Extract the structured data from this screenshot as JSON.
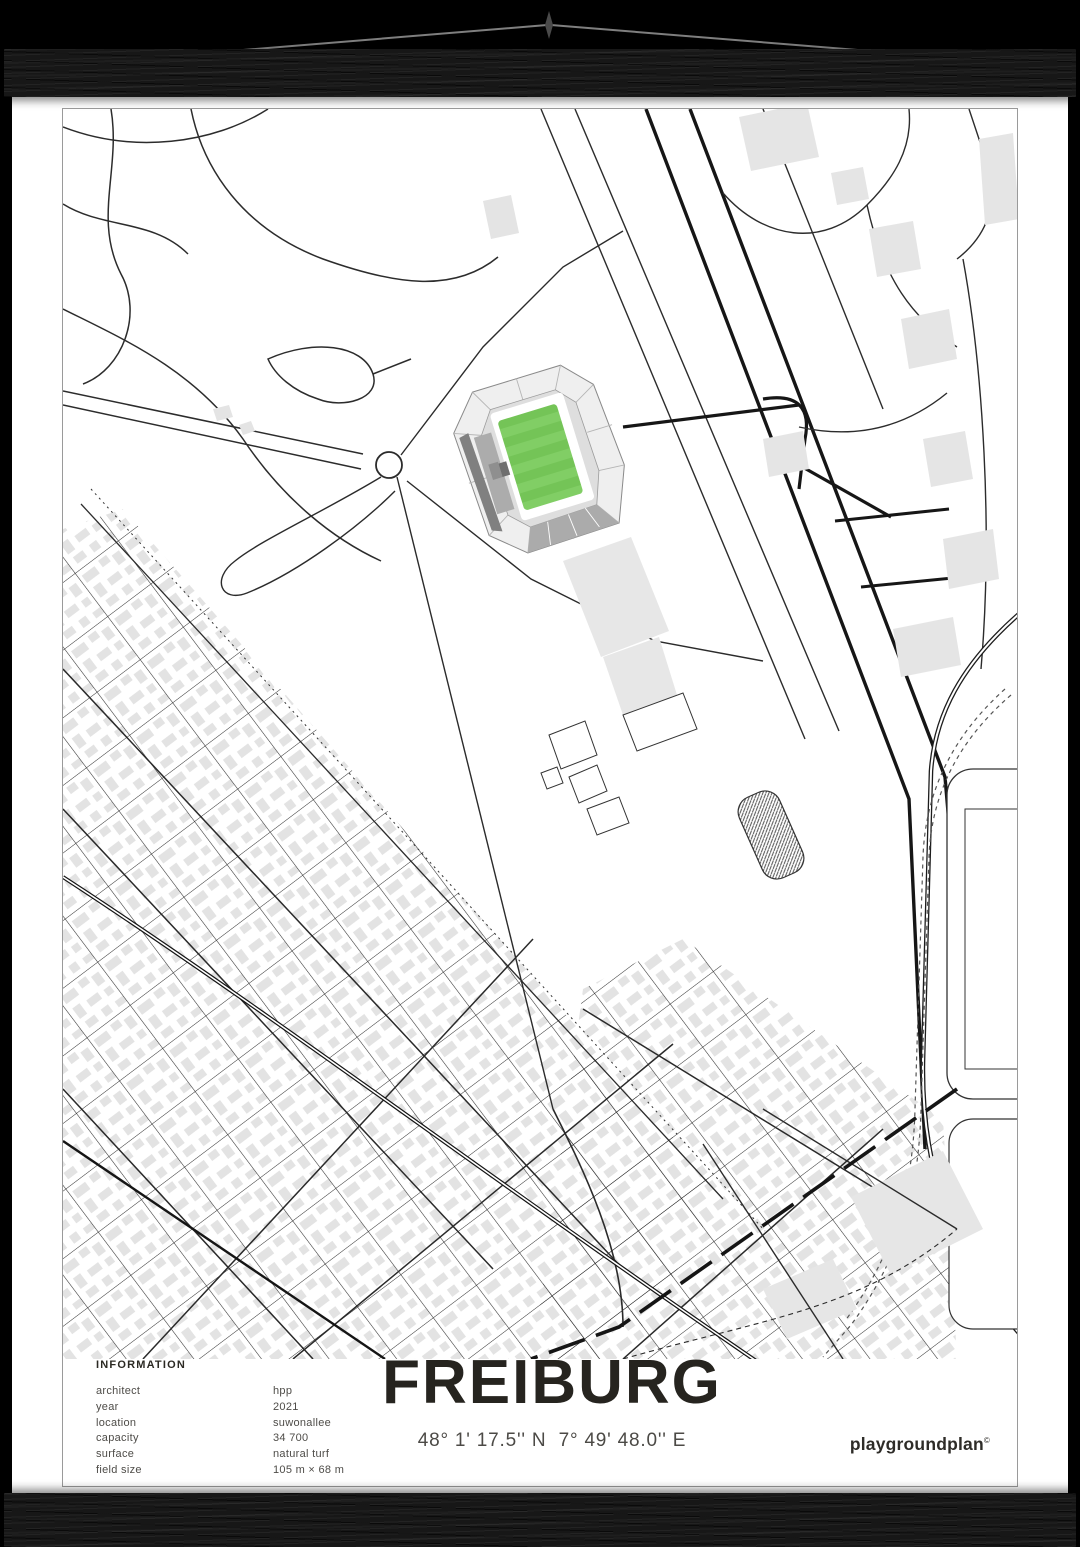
{
  "poster": {
    "title": "FREIBURG",
    "coordinates": "48° 1' 17.5'' N  7° 49' 48.0'' E",
    "brand": {
      "name": "playgroundplan",
      "mark": "©"
    },
    "information": {
      "heading": "INFORMATION",
      "rows": [
        {
          "label": "architect",
          "value": "hpp"
        },
        {
          "label": "year",
          "value": "2021"
        },
        {
          "label": "location",
          "value": "suwonallee"
        },
        {
          "label": "capacity",
          "value": "34 700"
        },
        {
          "label": "surface",
          "value": "natural turf"
        },
        {
          "label": "field size",
          "value": "105 m × 68 m"
        }
      ]
    }
  },
  "map": {
    "subject": "street map around Freiburg stadium (Europa-Park Stadion)",
    "colors": {
      "pitch_green": "#74C457",
      "pitch_stripe_light": "#81CE65",
      "building_gray": "#E3E3E3",
      "road_dark": "#1a1a1a",
      "stand_light": "#EFEFEF",
      "stand_dark": "#808080",
      "frame_border": "#9a9a9a",
      "cord_gray": "#808080",
      "hanger_black": "#171717"
    }
  }
}
